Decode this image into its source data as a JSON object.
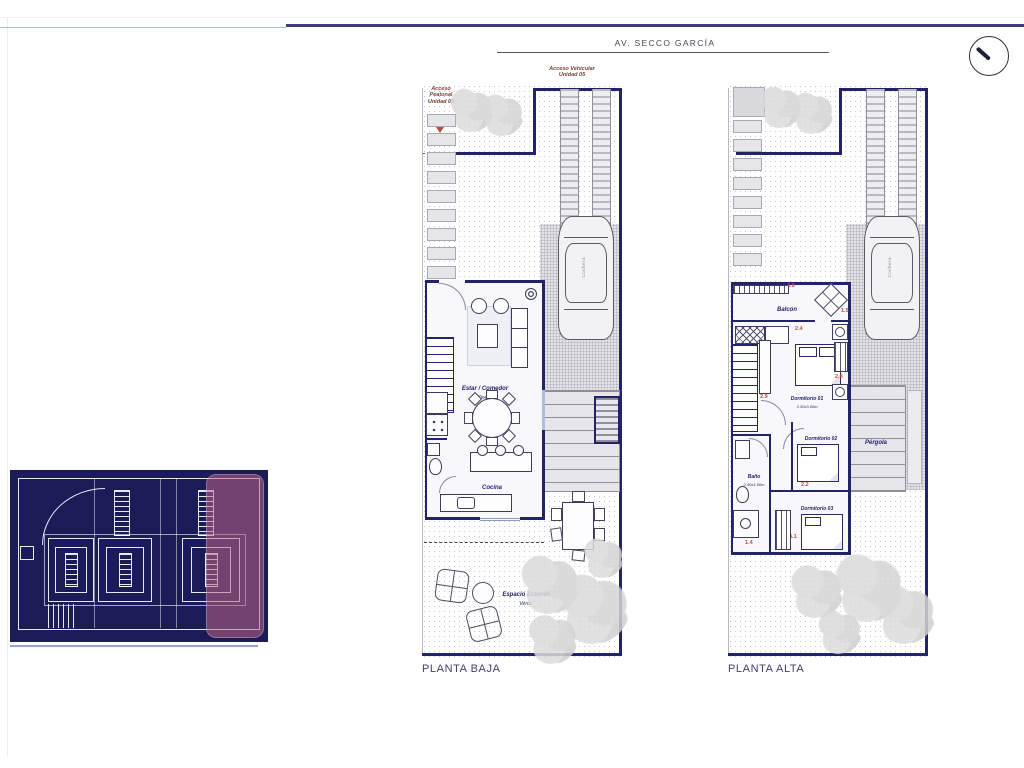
{
  "street": {
    "label": "AV. SECCO GARCÍA"
  },
  "compass": {
    "icon": "north-needle"
  },
  "titles": {
    "baja": "PLANTA BAJA",
    "alta": "PLANTA ALTA"
  },
  "baja": {
    "access_peatonal": "Acceso Peatonal Unidad 05",
    "access_vehicular": "Acceso Vehicular Unidad 05",
    "access_unidad": "Acceso Unidad 05",
    "living_name": "Estar / Comedor",
    "living_dims": "5.50x4.60m",
    "kitchen_name": "Cocina",
    "kitchen_dims": "4.05x1.90m",
    "exterior_name": "Espacio Exterior",
    "exterior_dims": "Verde",
    "garage": "Cochera"
  },
  "alta": {
    "balcony": "Balcón",
    "dorm1_name": "Dormitorio 01",
    "dorm1_dims": "3.30x3.60m",
    "dorm2_name": "Dormitorio 02",
    "dorm2_dims": "3.40x3.10m",
    "bath_name": "Baño",
    "bath_dims": "2.40x1.60m",
    "dorm3_name": "Dormitorio 03",
    "dorm3_dims": "3.10x3.60m",
    "pergola": "Pérgola",
    "garage": "Cochera",
    "dims": {
      "d48": "4.8",
      "d24": "2.4",
      "d28": "2.8",
      "d29": "2.9",
      "d22": "2.2",
      "d31": "3.1",
      "d14": "1.4",
      "d15": "1.5"
    }
  },
  "colors": {
    "wall": "#23236a",
    "accent_red": "#bc4a3c",
    "keyplan_bg": "#1b1b58",
    "keyplan_highlight": "#b26286",
    "top_bar": "#3d3d7c",
    "teal_line": "#9fc4c4"
  }
}
